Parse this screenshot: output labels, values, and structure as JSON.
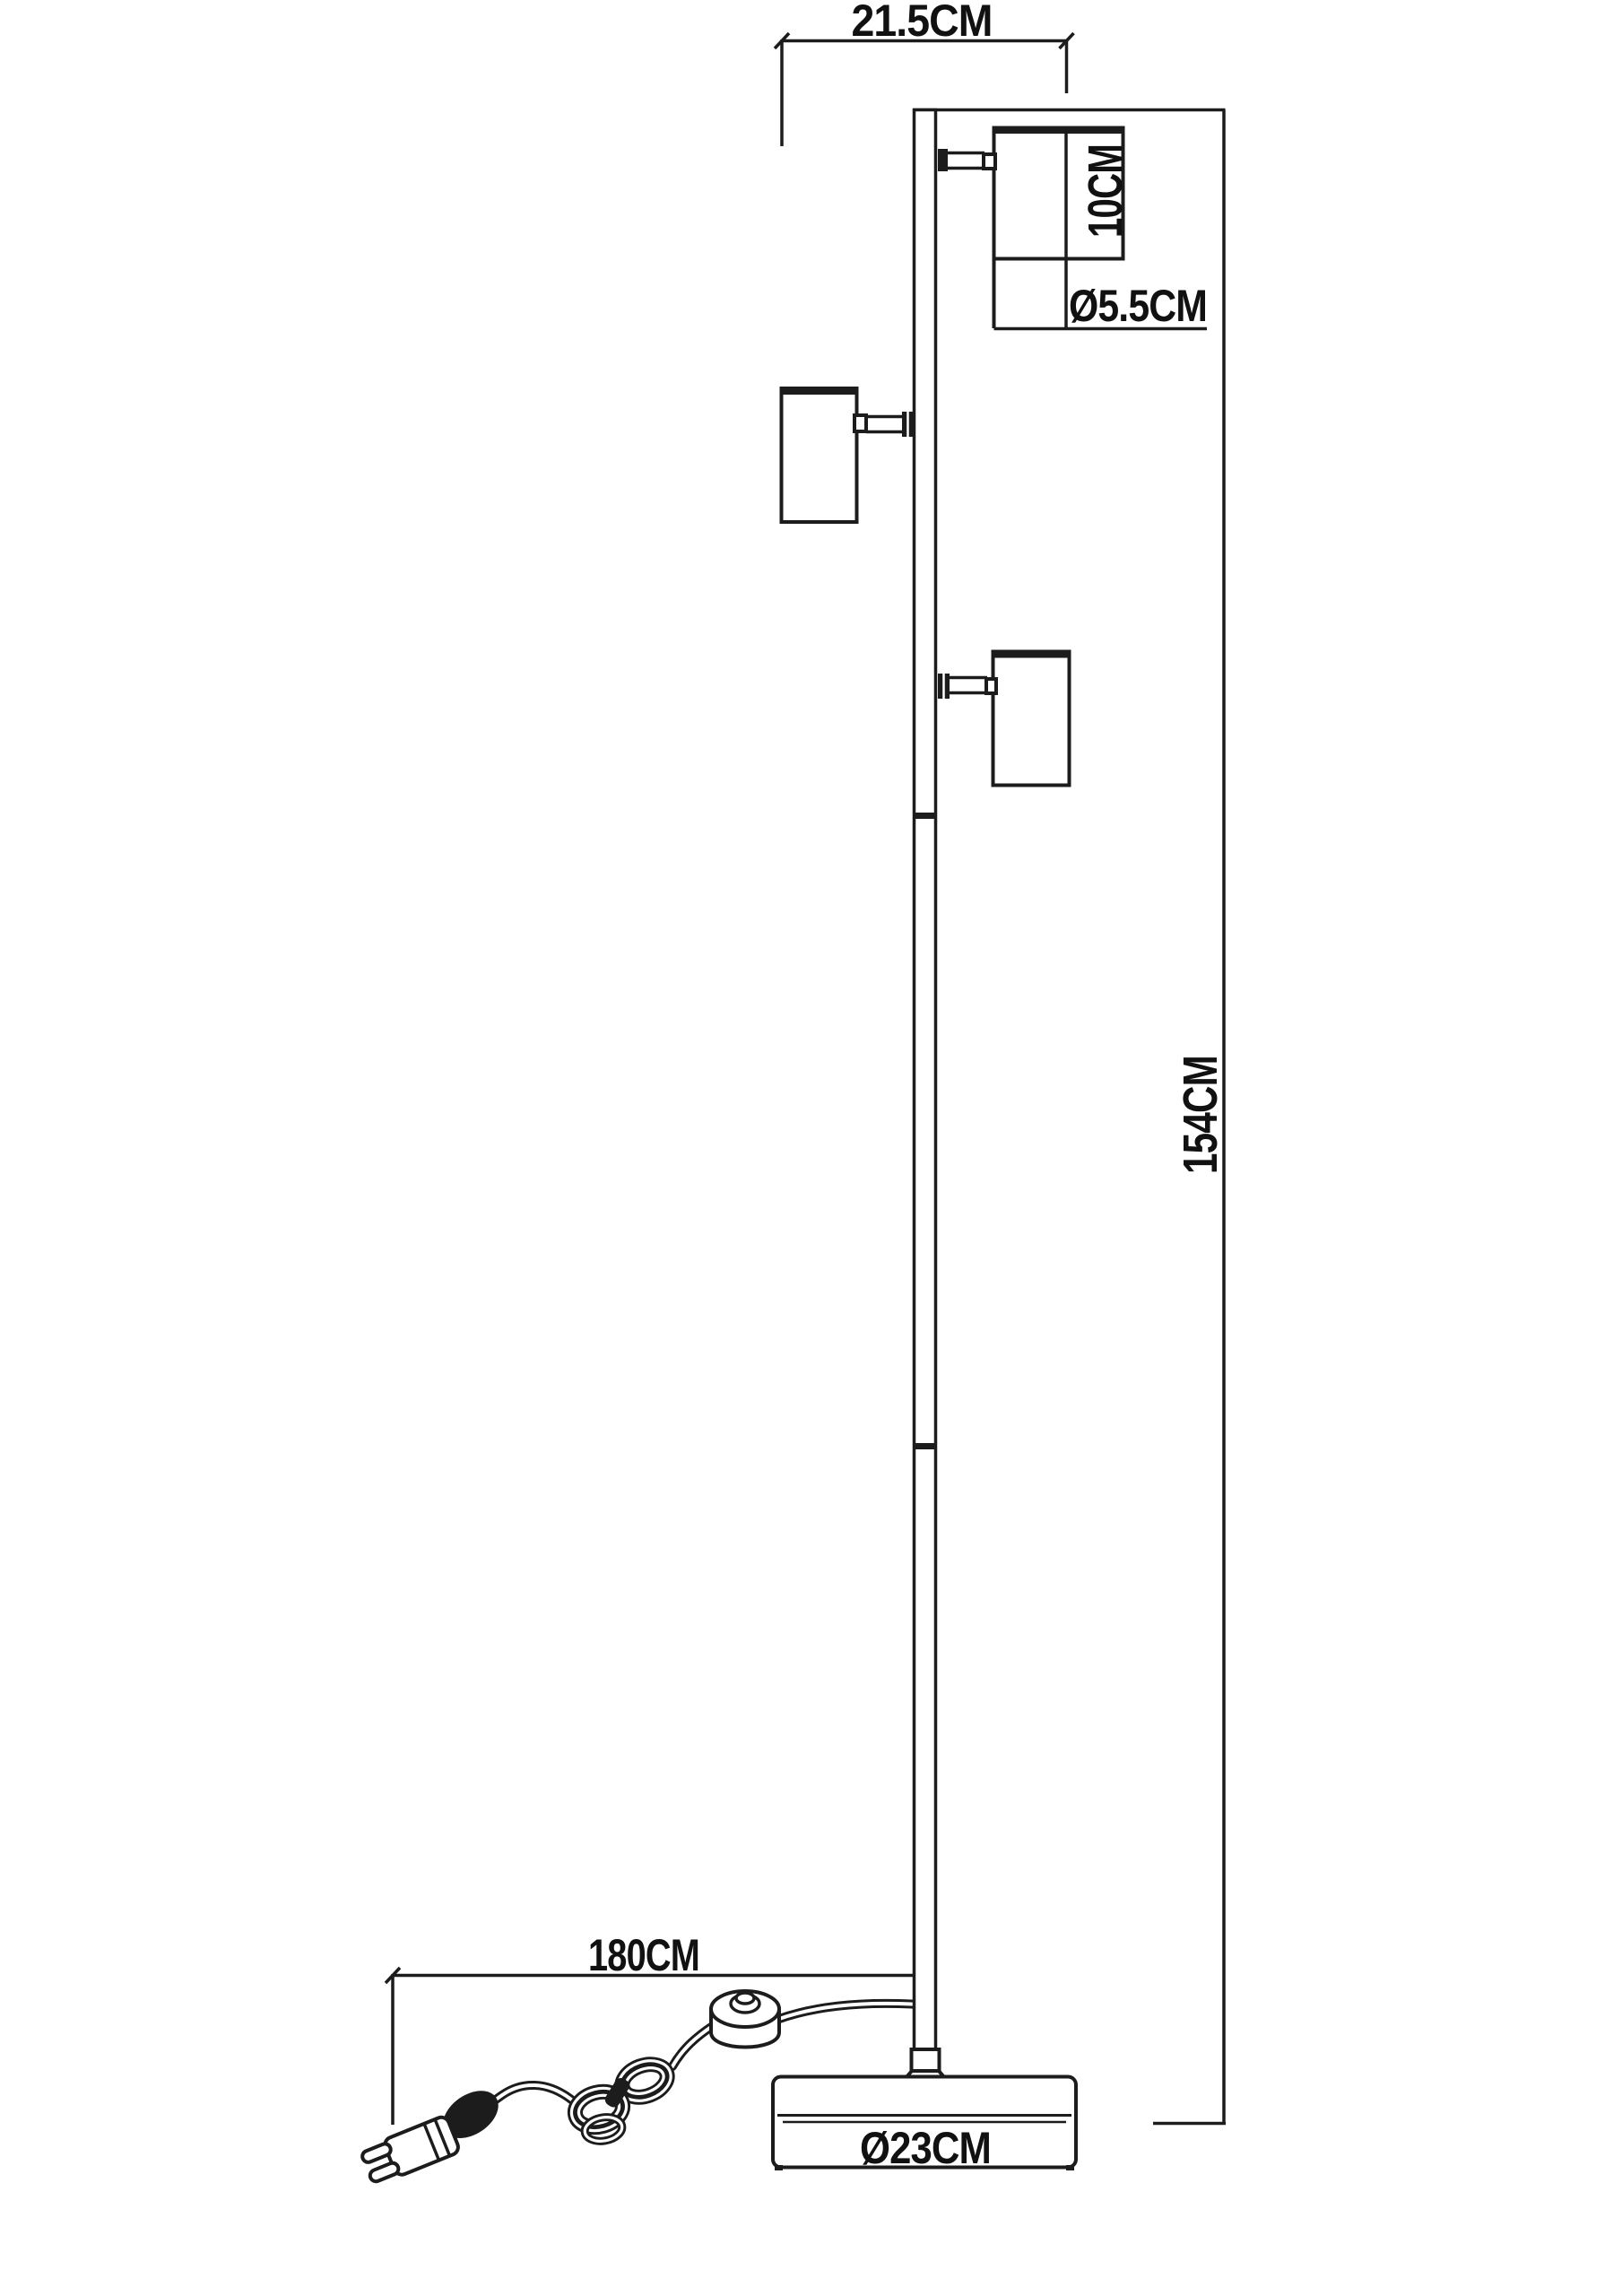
{
  "colors": {
    "line": "#1c1c1c",
    "text": "#111111",
    "background": "#ffffff"
  },
  "drawing_type": "floor-lamp-technical-dimension-drawing",
  "dimensions": {
    "top_width": {
      "label": "21.5CM"
    },
    "head_length": {
      "label": "10CM"
    },
    "head_diameter": {
      "label": "Ø5.5CM"
    },
    "total_height": {
      "label": "154CM"
    },
    "cord_length": {
      "label": "180CM"
    },
    "base_diameter": {
      "label": "Ø23CM"
    }
  }
}
